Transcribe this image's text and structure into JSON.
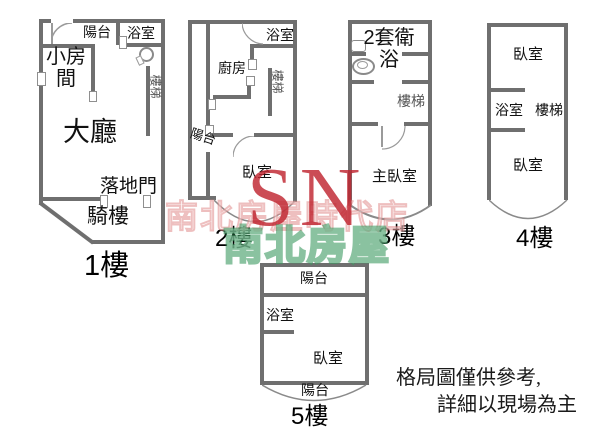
{
  "watermark": {
    "store_text": "南北房屋時代店",
    "logo": "SN",
    "brand": "南北房屋"
  },
  "disclaimer": {
    "line1": "格局圖僅供參考,",
    "line2": "詳細以現場為主"
  },
  "floors": {
    "f1": {
      "label": "1樓",
      "balcony": "陽台",
      "bath": "浴室",
      "small_room": "小房間",
      "stairs": "樓梯",
      "hall": "大廳",
      "french_door": "落地門",
      "arcade": "騎樓"
    },
    "f2": {
      "label": "2樓",
      "bath": "浴室",
      "kitchen": "廚房",
      "stairs": "樓梯",
      "balcony": "陽台",
      "bedroom": "臥室"
    },
    "f3": {
      "label": "3樓",
      "bath_suite": "2套衛浴",
      "stairs": "樓梯",
      "master": "主臥室"
    },
    "f4": {
      "label": "4樓",
      "bedroom_top": "臥室",
      "bath": "浴室",
      "stairs": "樓梯",
      "bedroom_bottom": "臥室"
    },
    "f5": {
      "label": "5樓",
      "balcony_top": "陽台",
      "bath": "浴室",
      "bedroom": "臥室",
      "balcony_bottom": "陽台"
    }
  },
  "colors": {
    "wall": "#6f6f6f",
    "thin_line": "#8a8a8a",
    "watermark_pink": "#e08a8a",
    "watermark_red": "#c0242f",
    "watermark_green": "#3c9a60"
  }
}
